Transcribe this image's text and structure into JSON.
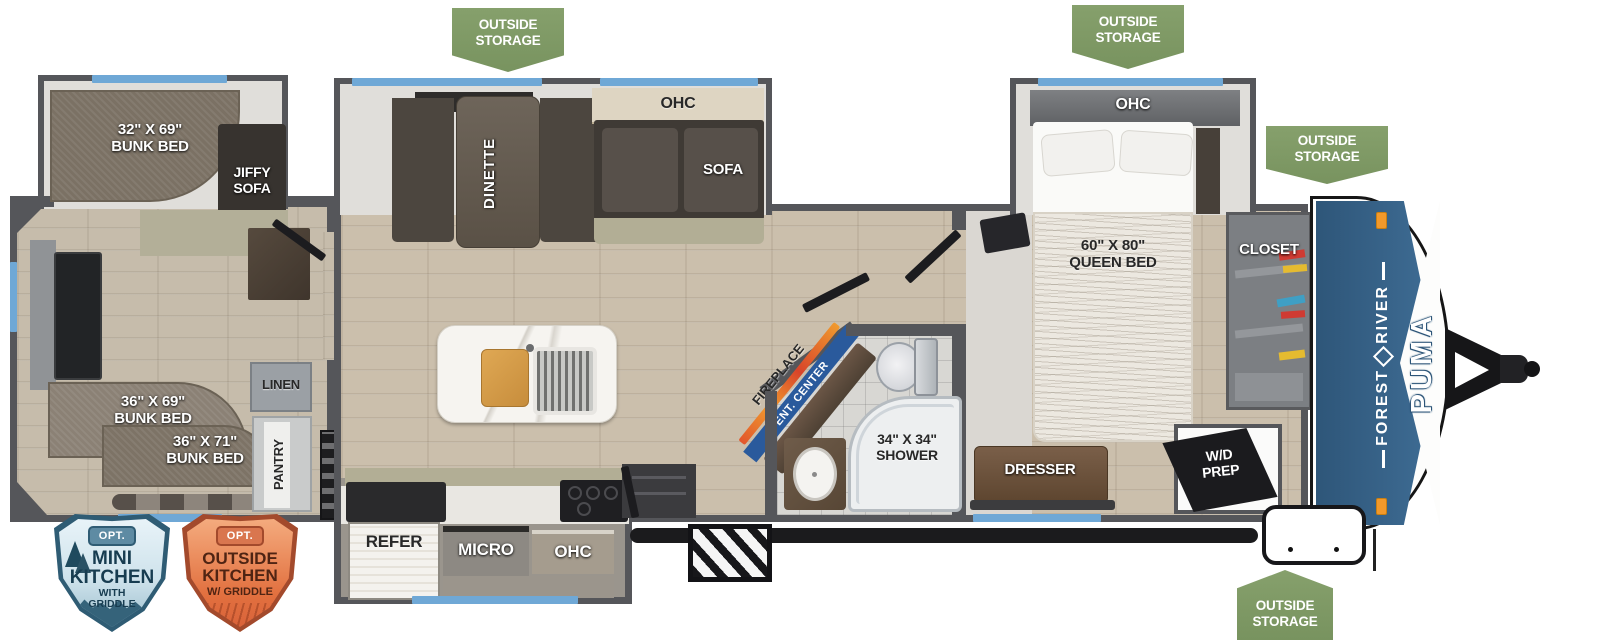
{
  "badges": {
    "outside_storage": "OUTSIDE\nSTORAGE"
  },
  "option_badges": {
    "mini": {
      "tag": "OPT.",
      "line1": "MINI",
      "line2": "KITCHEN",
      "sub": "WITH\nGRIDDLE"
    },
    "outside": {
      "tag": "OPT.",
      "line1": "OUTSIDE",
      "line2": "KITCHEN",
      "sub": "W/ GRIDDLE"
    }
  },
  "branding": {
    "make_parts": [
      "FOREST",
      "RIVER"
    ],
    "model": "PUMA"
  },
  "labels": {
    "bunk_32x69": "32\" X 69\"\nBUNK BED",
    "jiffy_sofa": "JIFFY\nSOFA",
    "bunk_36x69": "36\" X 69\"\nBUNK BED",
    "bunk_36x71": "36\" X 71\"\nBUNK BED",
    "linen": "LINEN",
    "pantry": "PANTRY",
    "dinette": "DINETTE",
    "ohc": "OHC",
    "sofa": "SOFA",
    "refer": "REFER",
    "micro": "MICRO",
    "fireplace": "FIREPLACE",
    "ent_center": "ENT. CENTER",
    "shower": "34\" X 34\"\nSHOWER",
    "queen_bed": "60\" X 80\"\nQUEEN BED",
    "closet": "CLOSET",
    "dresser": "DRESSER",
    "wd_prep": "W/D\nPREP"
  },
  "colors": {
    "badge_green": "#7d9864",
    "wall_gray": "#55565a",
    "window_blue": "#6fa8d6",
    "cap_blue": "#35608a",
    "marker_orange": "#f2992b"
  }
}
